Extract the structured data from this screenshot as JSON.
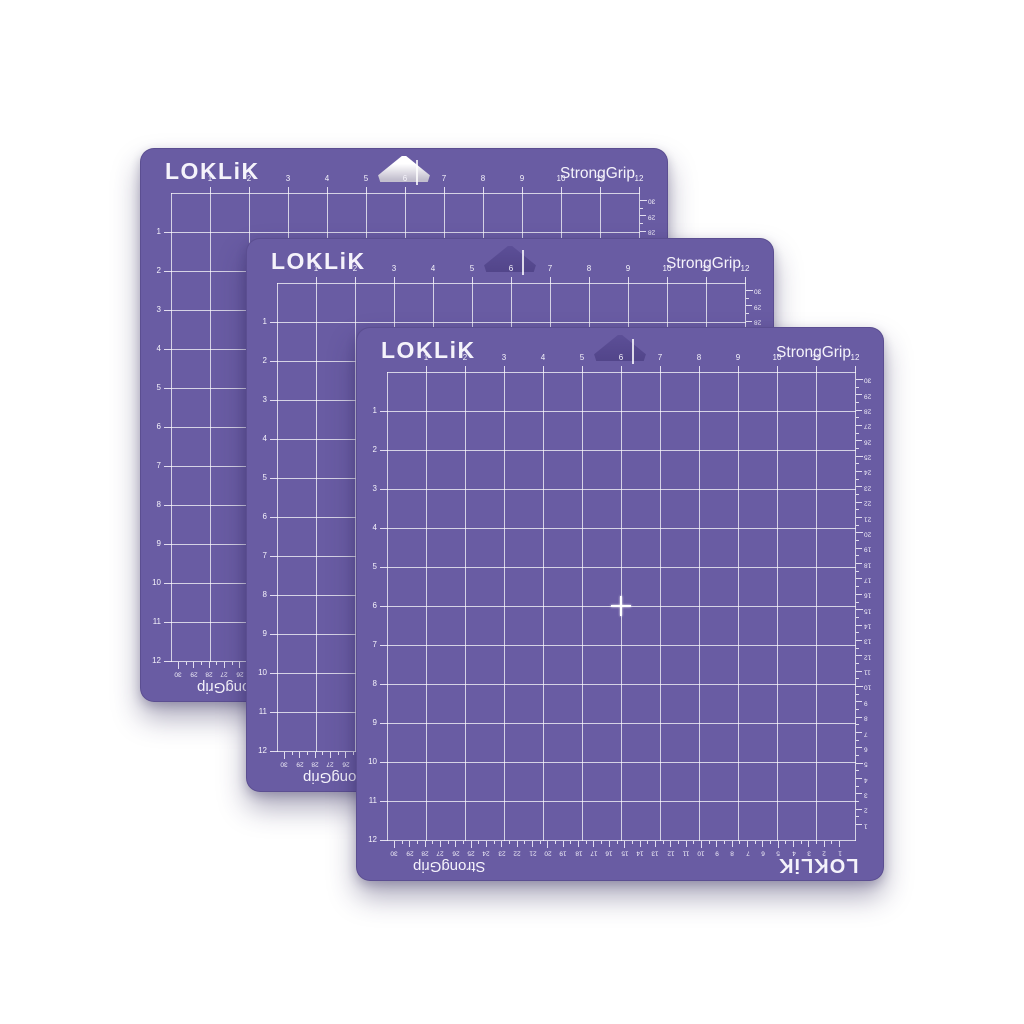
{
  "brand": "LOKLiK",
  "grip": "StrongGrip",
  "colors": {
    "background": "#ffffff",
    "mat": "#695ca3",
    "grid_line": "rgba(255,255,255,0.72)",
    "label": "#f5f3fb",
    "hole_light_a": "#ffffff",
    "hole_light_b": "#c3bfce",
    "hole_dark_a": "#5c4f97",
    "hole_dark_b": "#52458a"
  },
  "rulers": {
    "top_inches": [
      "1",
      "2",
      "3",
      "4",
      "5",
      "6",
      "7",
      "8",
      "9",
      "10",
      "11",
      "12"
    ],
    "left_inches": [
      "1",
      "2",
      "3",
      "4",
      "5",
      "6",
      "7",
      "8",
      "9",
      "10",
      "11",
      "12"
    ],
    "bottom_cm": [
      "30",
      "29",
      "28",
      "27",
      "26",
      "25",
      "24",
      "23",
      "22",
      "21",
      "20",
      "19",
      "18",
      "17",
      "16",
      "15",
      "14",
      "13",
      "12",
      "11",
      "10",
      "9",
      "8",
      "7",
      "6",
      "5",
      "4",
      "3",
      "2",
      "1"
    ],
    "right_cm": [
      "30",
      "29",
      "28",
      "27",
      "26",
      "25",
      "24",
      "23",
      "22",
      "21",
      "20",
      "19",
      "18",
      "17",
      "16",
      "15",
      "14",
      "13",
      "12",
      "11",
      "10",
      "9",
      "8",
      "7",
      "6",
      "5",
      "4",
      "3",
      "2",
      "1"
    ]
  },
  "mats": [
    {
      "id": "back",
      "left": 140,
      "top": 148,
      "hole": "light"
    },
    {
      "id": "middle",
      "left": 246,
      "top": 238,
      "hole": "dark"
    },
    {
      "id": "front",
      "left": 356,
      "top": 327,
      "hole": "dark"
    }
  ]
}
